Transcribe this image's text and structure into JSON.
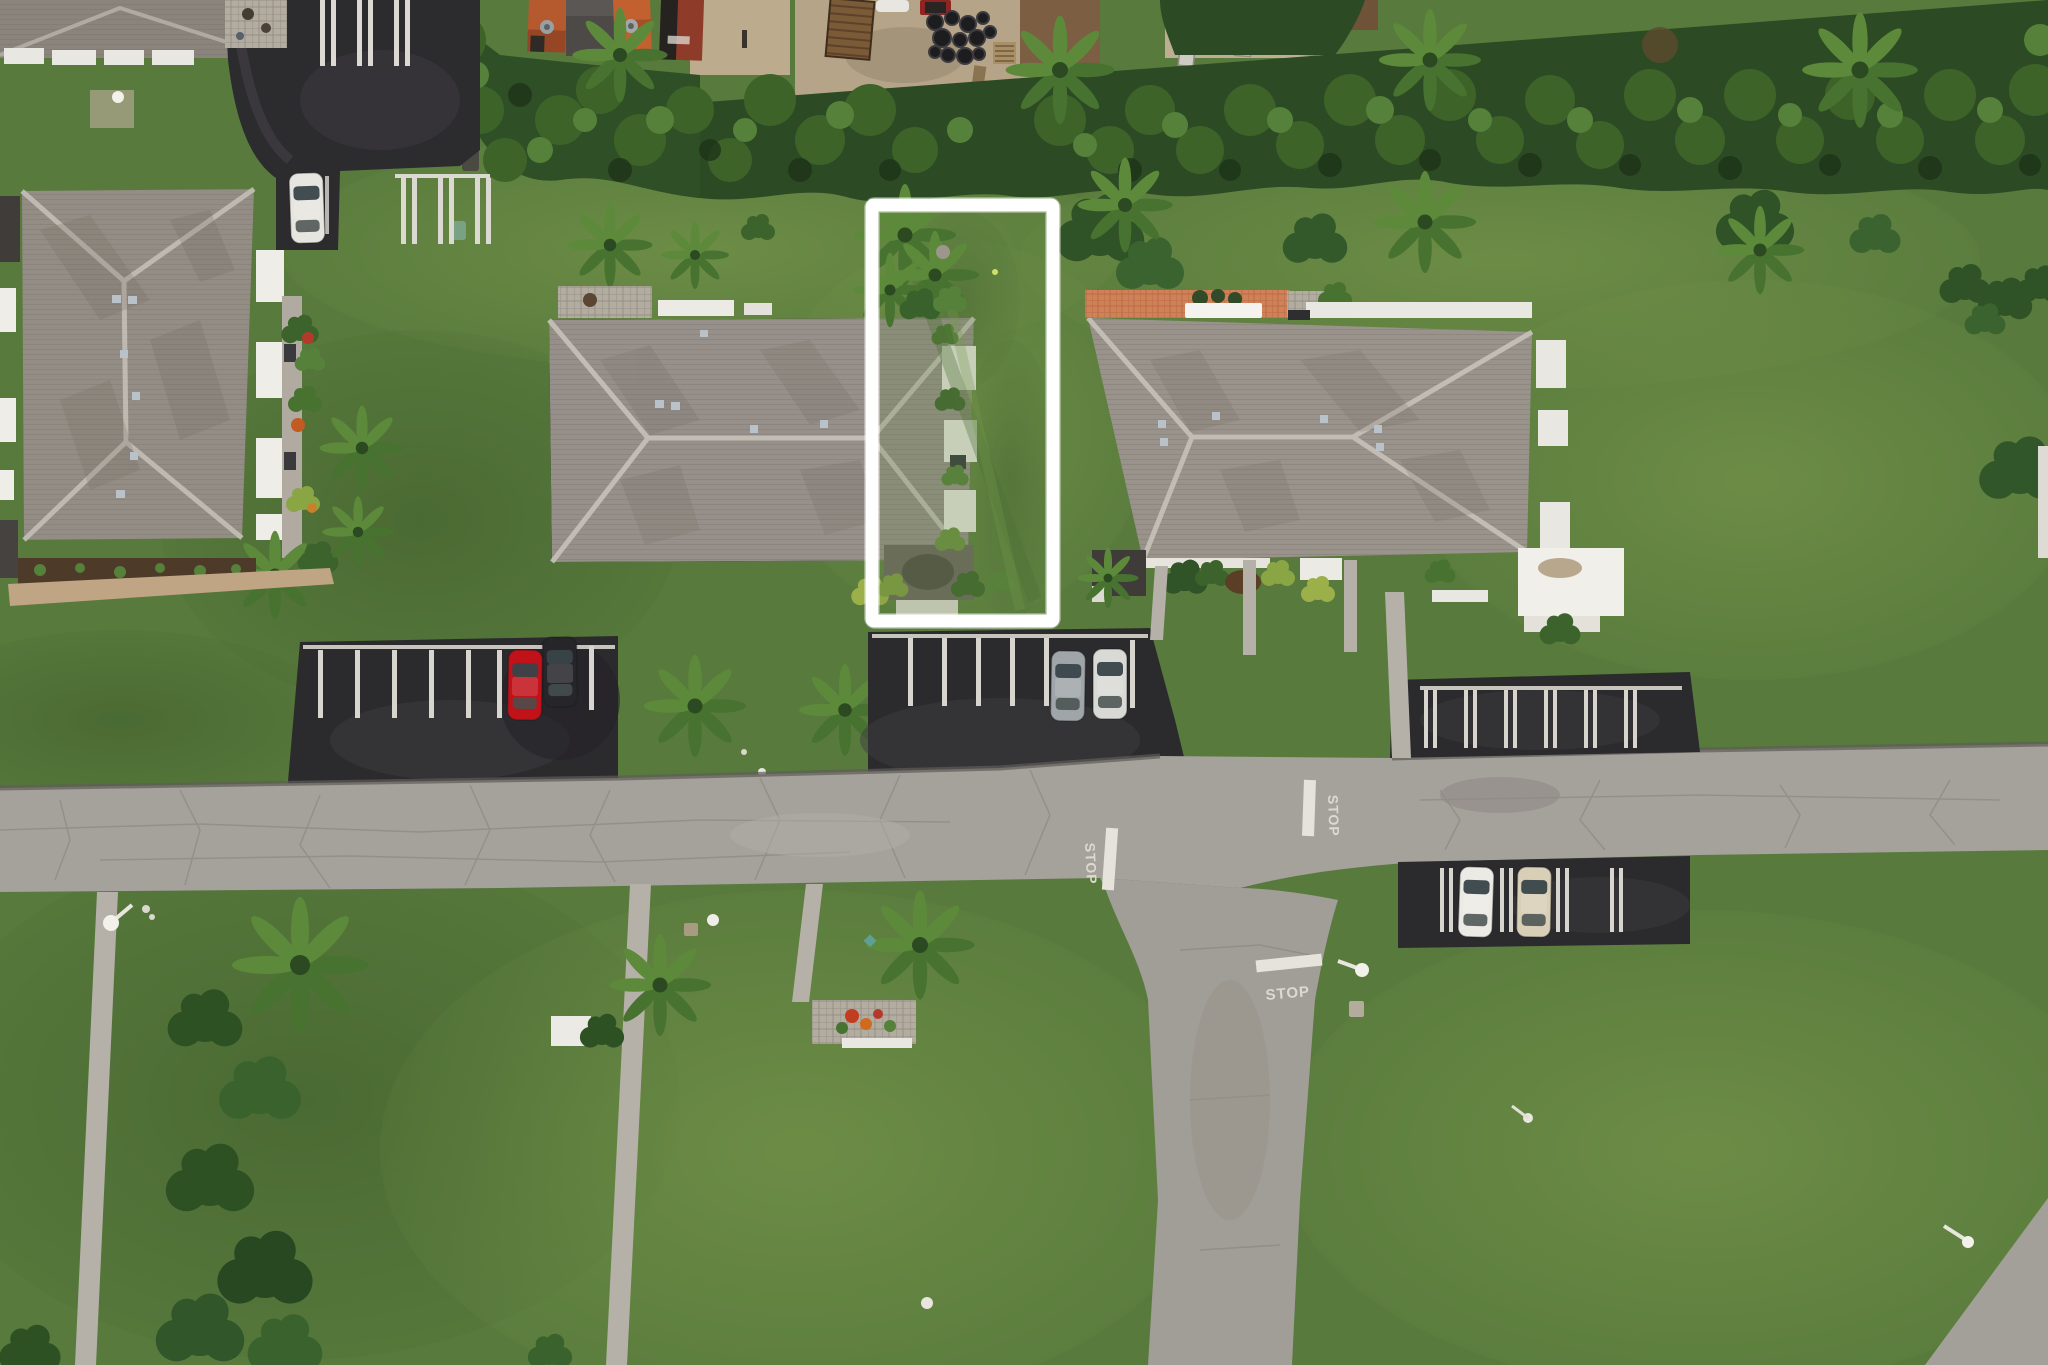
{
  "scene": {
    "description": "Aerial drone photo of a residential community; a vacant side lot is outlined with a white rectangle annotation",
    "annotation": {
      "name": "highlighted-lot-boundary",
      "stroke": "#ffffff",
      "stroke_width": 14
    },
    "road_markings": {
      "stop_west": {
        "text": "STOP"
      },
      "stop_east": {
        "text": "STOP"
      },
      "stop_south": {
        "text": "STOP"
      }
    },
    "vehicles": {
      "white_car_top_lot": {
        "color": "#e7e5df"
      },
      "red_car": {
        "color": "#c11219"
      },
      "dark_suv": {
        "color": "#26262a"
      },
      "silver_car": {
        "color": "#9fa5a8"
      },
      "white_car_lot2": {
        "color": "#d9d9d5"
      },
      "white_car_lot4": {
        "color": "#eceae5"
      },
      "beige_car_lot4": {
        "color": "#d8cfb6"
      }
    },
    "palette": {
      "grass": "#587a3c",
      "road": "#a5a19b",
      "asphalt": "#2c2b2e",
      "roof": "#948d85",
      "hedge": "#2c4a24",
      "sidewalk": "#b6b1a8"
    }
  }
}
